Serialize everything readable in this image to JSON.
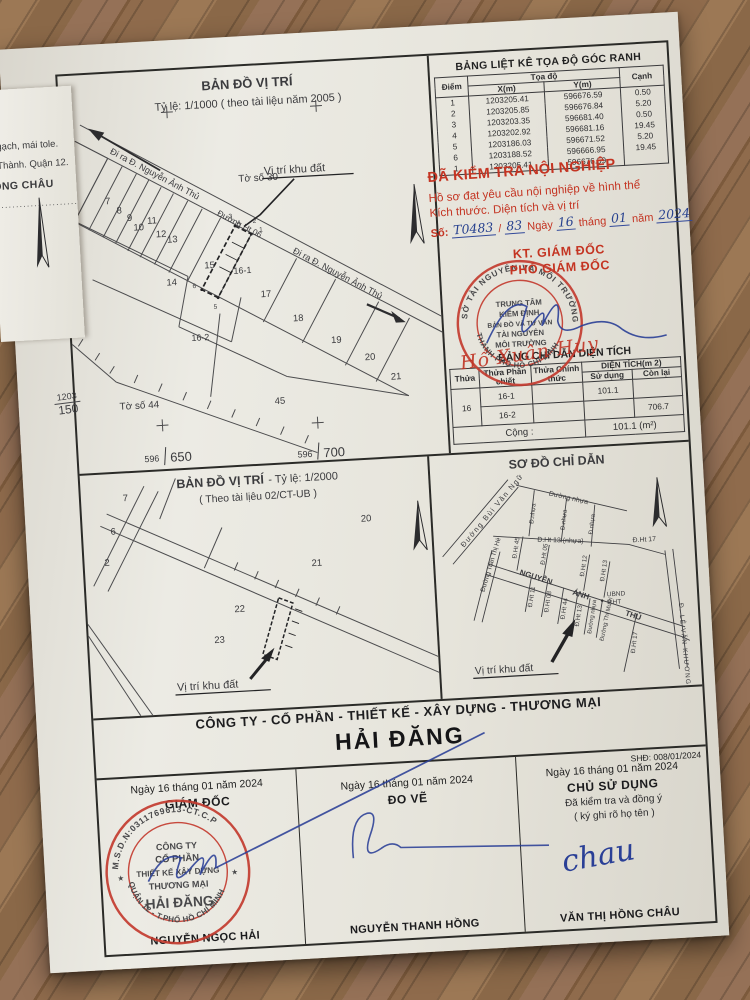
{
  "margin": {
    "fold": {
      "line1": "ng gạch, mái tole.",
      "line2": "ệp Thành. Quận 12.",
      "line3": "HỒNG CHÂU",
      "dots": "·······························"
    },
    "grid": [
      {
        "t": "1203",
        "b": "250"
      },
      {
        "t": "1203",
        "b": "200"
      },
      {
        "t": "1203",
        "b": "150"
      }
    ]
  },
  "map1": {
    "title": "BẢN ĐỒ VỊ TRÍ",
    "scale": "Tỷ lệ: 1/1000 ( theo tài liệu năm 2005 )",
    "sheet_top": "Tờ số 30",
    "sheet_bottom": "Tờ số 44",
    "exit_road_top": "Đi ra Đ. Nguyễn Ảnh Thủ",
    "road_ht06": "Đường Ht 06",
    "exit_road_mid": "Đi ra Đ. Nguyễn Ảnh Thủ",
    "site_label": "Vị trí khu đất",
    "grid_a1": "596",
    "grid_a2": "650",
    "grid_b1": "596",
    "grid_b2": "700",
    "parcels": {
      "p6": "6",
      "p7": "7",
      "p8": "8",
      "p9": "9",
      "p10": "10",
      "p11": "11",
      "p12": "12",
      "p13": "13",
      "p14": "14",
      "p15": "15",
      "p16_1": "16-1",
      "p16_2": "16-2",
      "p17": "17",
      "p18": "18",
      "p19": "19",
      "p20": "20",
      "p21": "21",
      "p45": "45"
    },
    "points": {
      "n1": "1",
      "n2": "2",
      "n3": "3",
      "n4": "4",
      "n5": "5",
      "n6": "6"
    }
  },
  "coord_table": {
    "title": "BẢNG LIỆT KÊ TỌA ĐỘ GÓC RANH",
    "h_point": "Điểm",
    "h_coord": "Tọa độ",
    "h_x": "X(m)",
    "h_y": "Y(m)",
    "h_edge": "Cạnh",
    "rows": [
      {
        "p": "1",
        "x": "1203205.41",
        "y": "596676.59",
        "c": "0.50"
      },
      {
        "p": "2",
        "x": "1203205.85",
        "y": "596676.84",
        "c": "5.20"
      },
      {
        "p": "3",
        "x": "1203203.35",
        "y": "596681.40",
        "c": "0.50"
      },
      {
        "p": "4",
        "x": "1203202.92",
        "y": "596681.16",
        "c": "19.45"
      },
      {
        "p": "5",
        "x": "1203186.03",
        "y": "596671.52",
        "c": "5.20"
      },
      {
        "p": "6",
        "x": "1203188.52",
        "y": "596666.95",
        "c": "19.45"
      },
      {
        "p": "1",
        "x": "1203205.41",
        "y": "596676.59",
        "c": ""
      }
    ]
  },
  "inspection": {
    "line1": "ĐÃ KIỂM TRA NỘI NGHIỆP",
    "line2": "Hồ sơ đạt yêu cầu nội nghiệp về hình thể",
    "line3": "Kích thước. Diện tích và vị trí",
    "so_label": "Số:",
    "so_value": "T0483",
    "so_sep": "/",
    "so_value2": "83",
    "ngay": "Ngày",
    "day": "16",
    "thang": "tháng",
    "month": "01",
    "nam": "năm",
    "year": "2024",
    "kt": "KT. GIÁM ĐỐC",
    "pho": "PHÓ GIÁM ĐỐC",
    "stamp": {
      "ring_top": "SỞ TÀI NGUYÊN VÀ MÔI TRƯỜNG",
      "ring_bottom": "THÀNH PHỐ HỒ CHÍ MINH",
      "l1": "TRUNG TÂM",
      "l2": "KIỂM ĐỊNH",
      "l3": "BẢN ĐỒ VÀ TƯ VẤN",
      "l4": "TÀI NGUYÊN",
      "l5": "MÔI TRƯỜNG"
    },
    "signed_name": "Hồ Xuân Huy"
  },
  "area_table": {
    "title": "BẢNG CHỈ DẪN DIỆN TÍCH",
    "h_thua": "Thửa",
    "h_phan_chiet": "Thửa Phân chiết",
    "h_chinh_thuc": "Thửa Chính thức",
    "h_dien_tich": "DIỆN TÍCH(m 2)",
    "h_su_dung": "Sử dụng",
    "h_con_lai": "Còn lại",
    "rows": [
      {
        "thua": "16",
        "pc": "16-1",
        "ct": "",
        "sd": "101.1",
        "cl": ""
      },
      {
        "thua": "",
        "pc": "16-2",
        "ct": "",
        "sd": "",
        "cl": "706.7"
      }
    ],
    "total_label": "Cộng :",
    "total_value": "101.1 (m²)"
  },
  "map2": {
    "title": "BẢN ĐỒ VỊ TRÍ",
    "scale": " - Tỷ lệ: 1/2000",
    "source": "( Theo tài lịêu 02/CT-UB )",
    "site_label": "Vị trí khu đất",
    "parcels": {
      "p2": "2",
      "p6": "6",
      "p7": "7",
      "p20": "20",
      "p21": "21",
      "p22": "22",
      "p23": "23"
    }
  },
  "sketch": {
    "title": "SƠ ĐỒ CHỈ DẪN",
    "bui_van_ngu": "Đường  Bùi  Văn  Ngữ",
    "duong_nhua_top": "Đường nhựa",
    "d_nhua_1": "Đ.nhựa",
    "d_nhua_2": "Đ.nhựa",
    "d_nhua_3": "Đ.nhựa",
    "ht13_nhua": "Đ.Ht 13 (nhựa)",
    "ht17_top": "Đ.Ht 17",
    "tran_thi_he": "Đường Trần Thị Hè",
    "nguyen": "NGUYỄN",
    "anh": "ÁNH",
    "thu": "THỦ",
    "ht45": "Đ.Ht 45",
    "ht05": "Đ.Ht 05",
    "ht12": "Đ.Ht 12",
    "ht13a": "Đ.Ht 13",
    "ht11": "Đ.Ht 11",
    "ht08": "Đ.Ht 08",
    "ht44": "Đ.Ht 44",
    "ht13b": "Đ.Ht 13",
    "ht17_bot": "Đ.Ht 17",
    "duong_nhua_bot": "Đường nhựa",
    "thi_muoi": "Đường Thi Mười",
    "le_van_khuong": "Đ. LÊ VĂN KHƯƠNG",
    "ubnd1": "UBND",
    "ubnd2": "P.HT",
    "site_label": "Vị trí khu đất"
  },
  "footer": {
    "company_line": "CÔNG TY - CỔ PHẦN - THIẾT KẾ - XÂY DỰNG - THƯƠNG MẠI",
    "company_name": "HẢI ĐĂNG",
    "shd": "SHĐ: 008/01/2024",
    "col1": {
      "date": "Ngày 16 tháng 01 năm 2024",
      "role": "GIÁM ĐỐC",
      "name": "NGUYỄN NGỌC HẢI"
    },
    "col2": {
      "date": "Ngày 16 tháng 01 năm 2024",
      "role": "ĐO VẼ",
      "name": "NGUYỄN THANH HỒNG"
    },
    "col3": {
      "date": "Ngày 16 tháng 01 năm 2024",
      "role": "CHỦ SỬ DỤNG",
      "note1": "Đã kiểm tra và đồng ý",
      "note2": "( ký ghi rõ họ tên )",
      "signature": "chau",
      "name": "VĂN THỊ HỒNG CHÂU"
    },
    "stamp": {
      "ring_top": "M.S.D.N:0311769613-CT.C.P",
      "ring_bottom": "QUẬN 12 - T.PHỐ HỒ CHÍ MINH",
      "star": "★",
      "l1": "CÔNG TY",
      "l2": "CỔ PHẦN",
      "l3": "THIẾT KẾ XÂY DỰNG",
      "l4": "THƯƠNG MẠI",
      "l5": "HẢI ĐĂNG"
    }
  }
}
